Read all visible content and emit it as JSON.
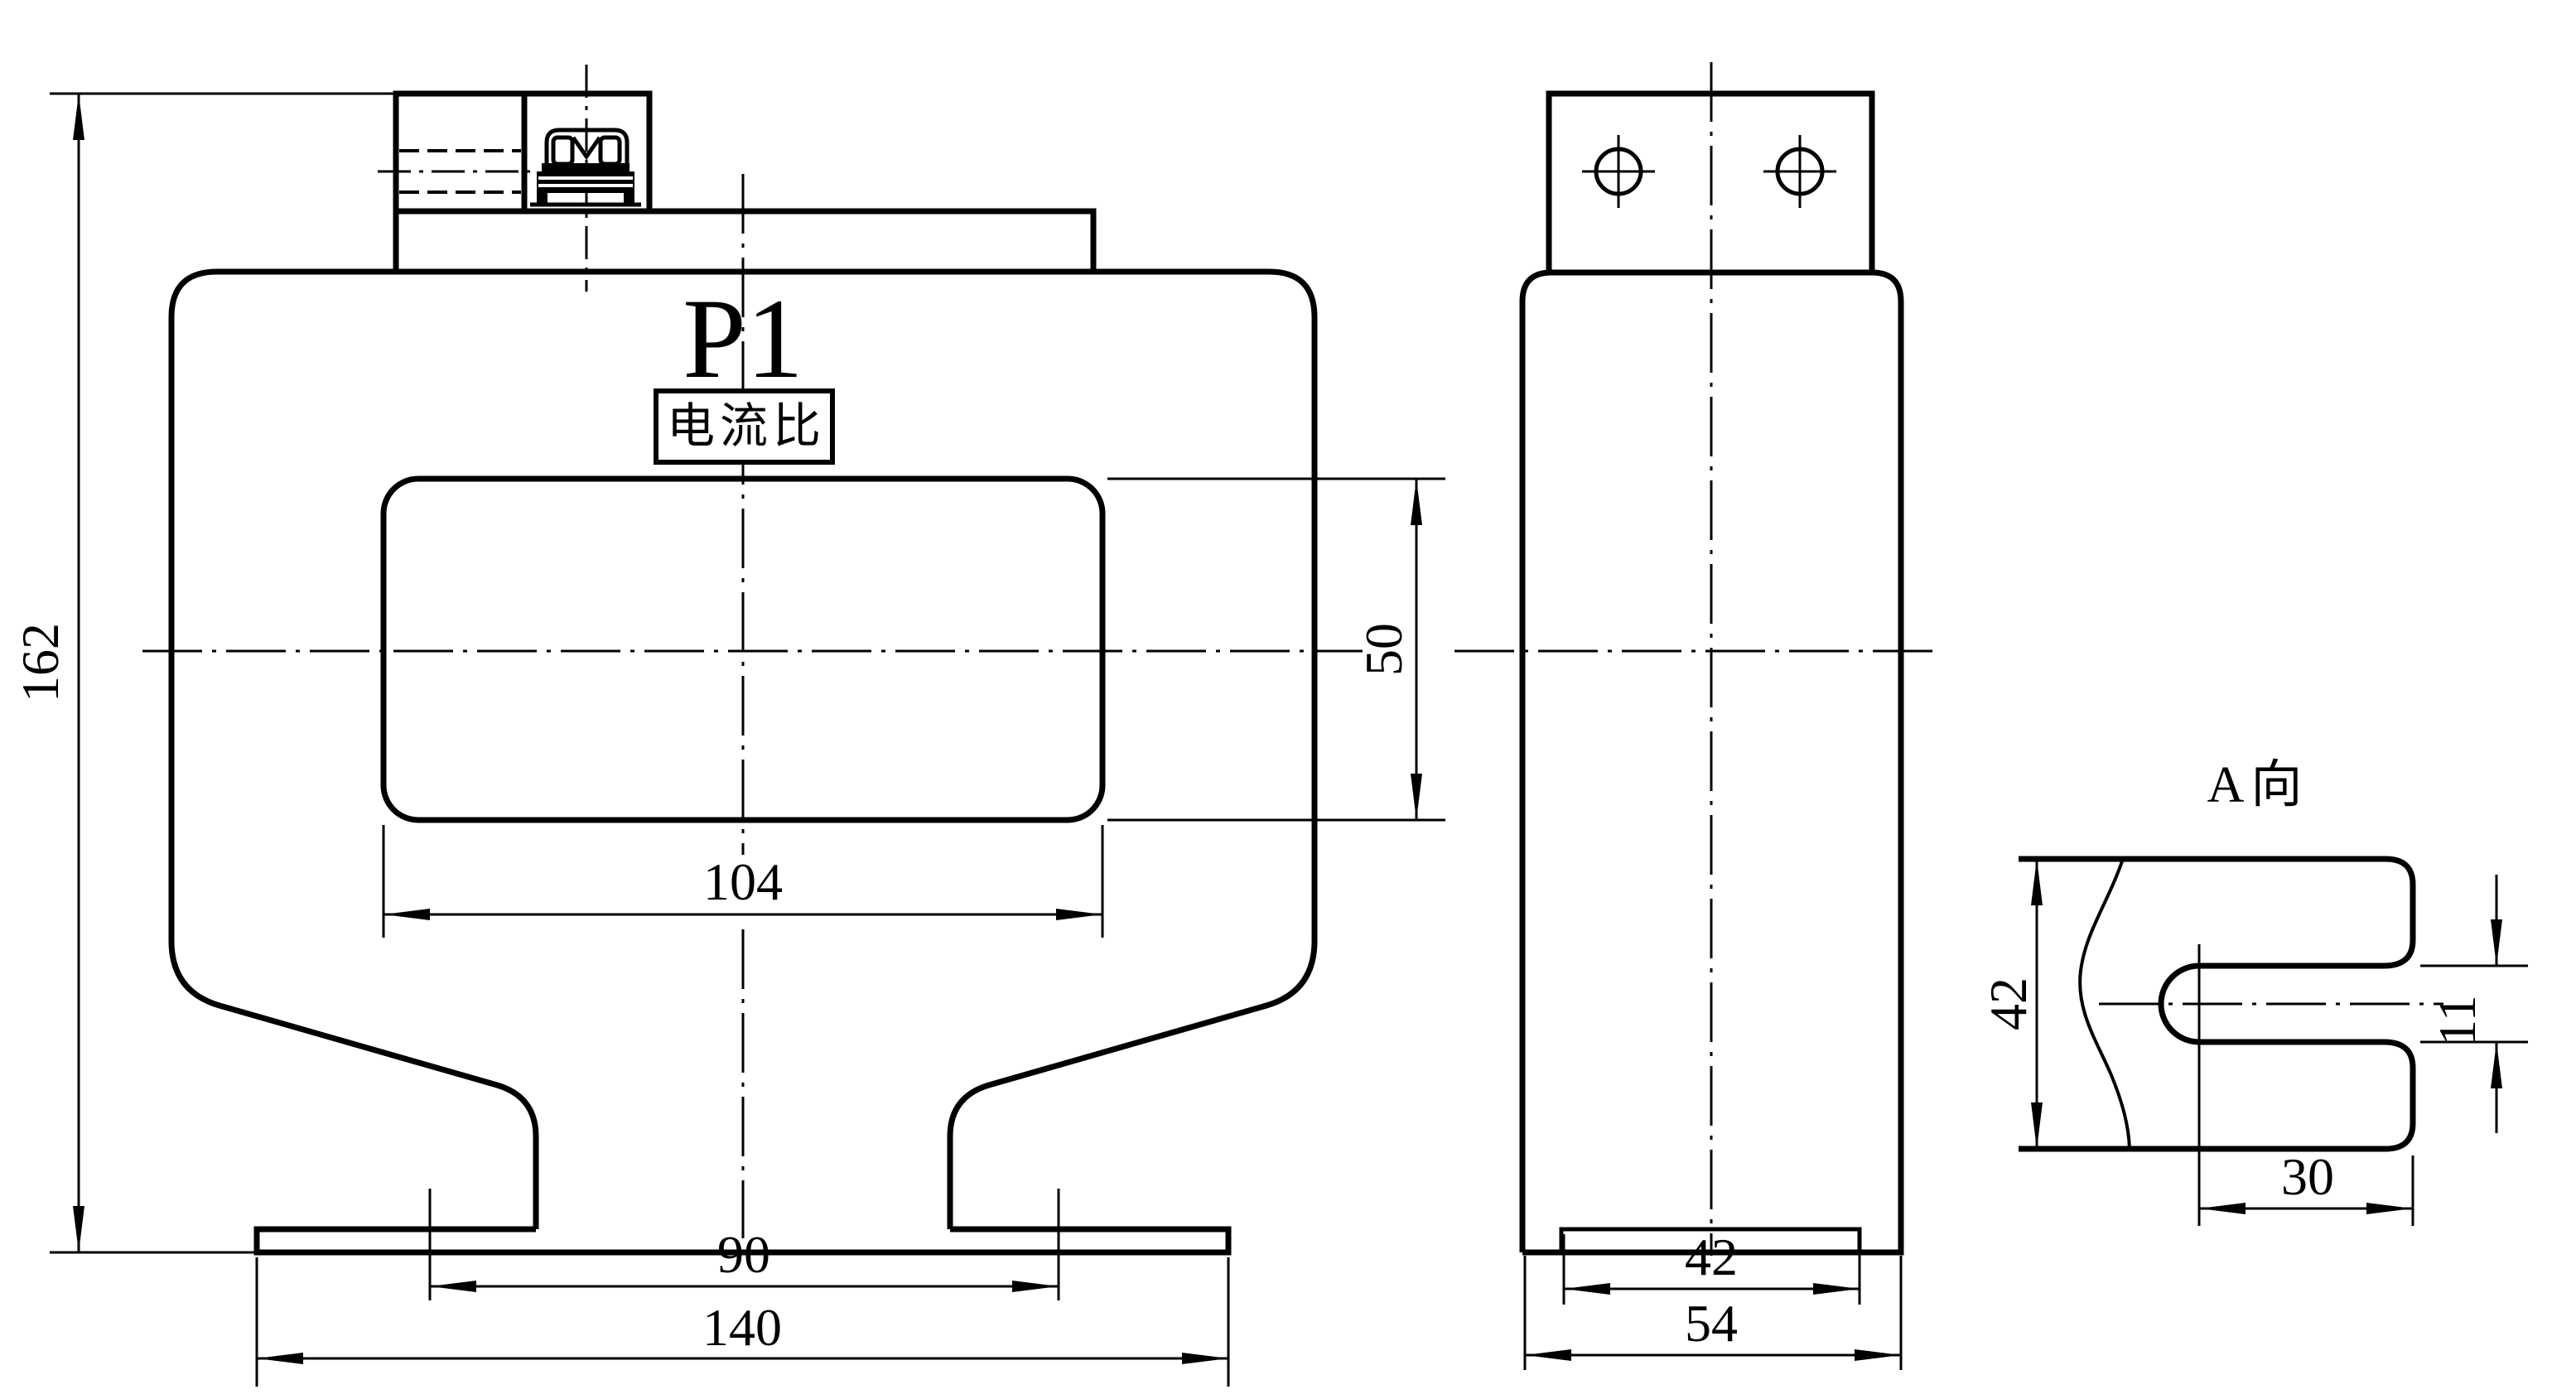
{
  "colors": {
    "background": "#ffffff",
    "line": "#000000"
  },
  "views": {
    "front": {
      "terminal_polarity_label": "P1",
      "nameplate_text": "电流比",
      "dim_overall_height": "162",
      "dim_window_width": "104",
      "dim_window_height": "50",
      "dim_mounting_slot_spacing": "90",
      "dim_base_length": "140"
    },
    "side": {
      "dim_base_depth": "42",
      "dim_body_depth": "54"
    },
    "view_a": {
      "label": "A向",
      "dim_height": "42",
      "dim_slot_width": "11",
      "dim_slot_depth": "30"
    }
  }
}
